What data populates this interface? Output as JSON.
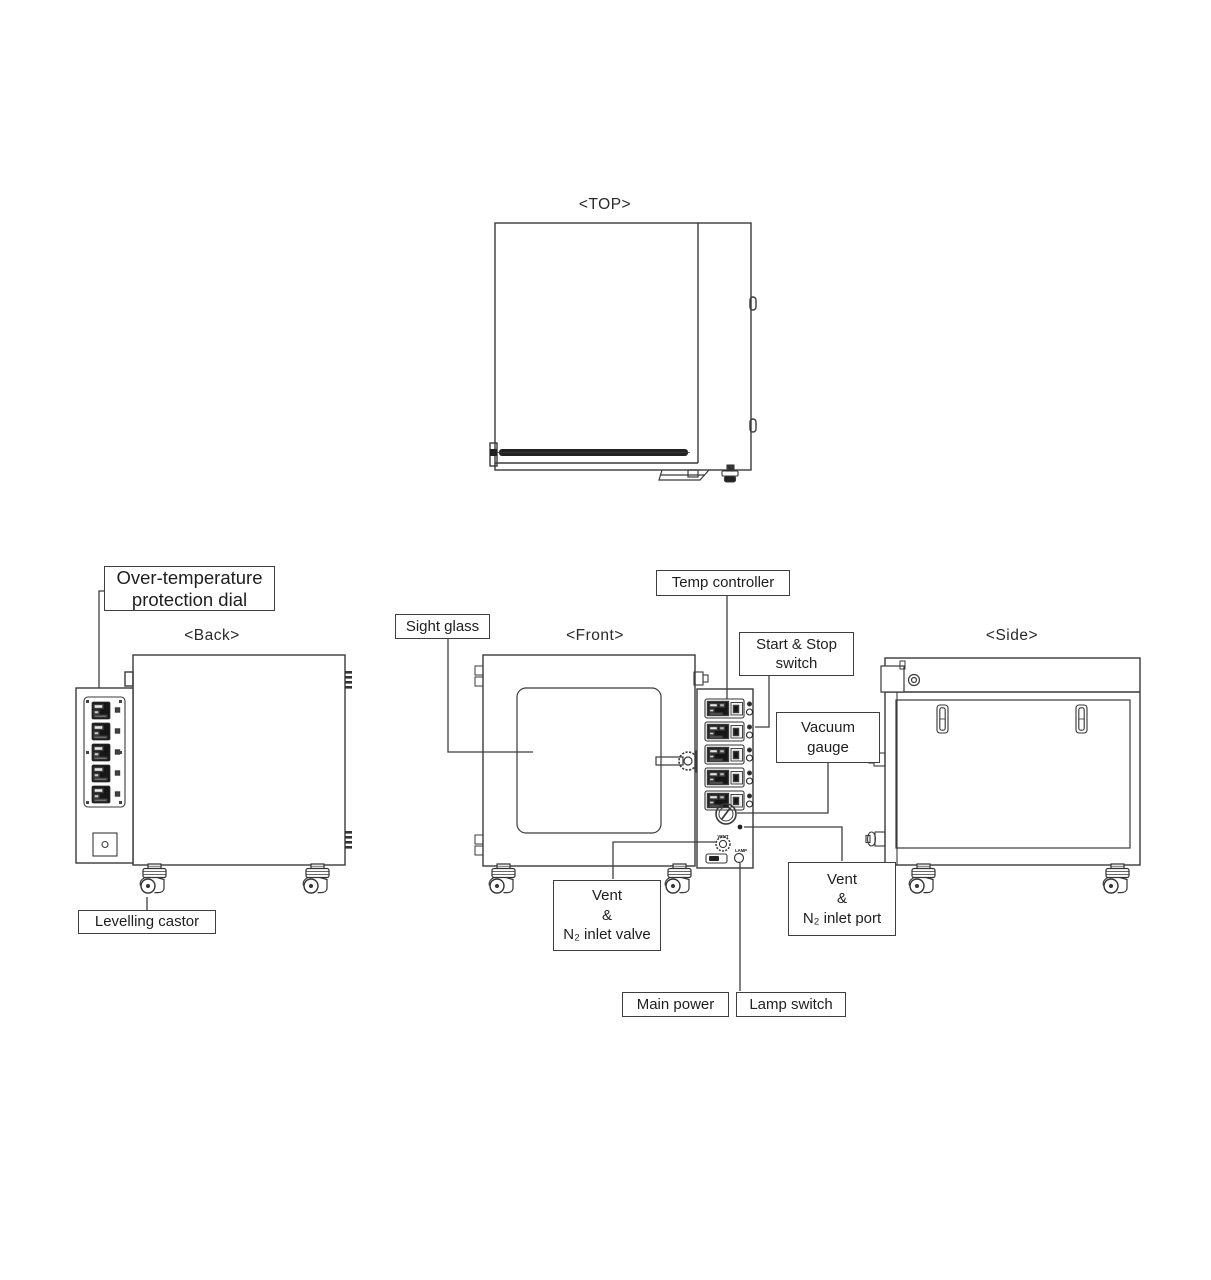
{
  "diagram": {
    "views": {
      "top": {
        "title": "<TOP>"
      },
      "back": {
        "title": "<Back>"
      },
      "front": {
        "title": "<Front>"
      },
      "side": {
        "title": "<Side>"
      }
    },
    "labels": {
      "over_temp_line1": "Over-temperature",
      "over_temp_line2": "protection dial",
      "sight_glass": "Sight glass",
      "temp_controller": "Temp controller",
      "start_stop_line1": "Start & Stop",
      "start_stop_line2": "switch",
      "vacuum_gauge_line1": "Vacuum",
      "vacuum_gauge_line2": "gauge",
      "vent_port_line1": "Vent",
      "vent_port_line2": "&",
      "vent_port_line3": "N₂ inlet port",
      "vent_valve_line1": "Vent",
      "vent_valve_line2": "&",
      "vent_valve_line3": "N₂ inlet valve",
      "main_power": "Main power",
      "lamp_switch": "Lamp switch",
      "levelling_castor": "Levelling castor"
    },
    "panel_micro_labels": {
      "vent": "VENT",
      "lamp": "LAMP"
    },
    "colors": {
      "line": "#3a3a3a",
      "background": "#ffffff",
      "display_fill": "#161616"
    }
  }
}
